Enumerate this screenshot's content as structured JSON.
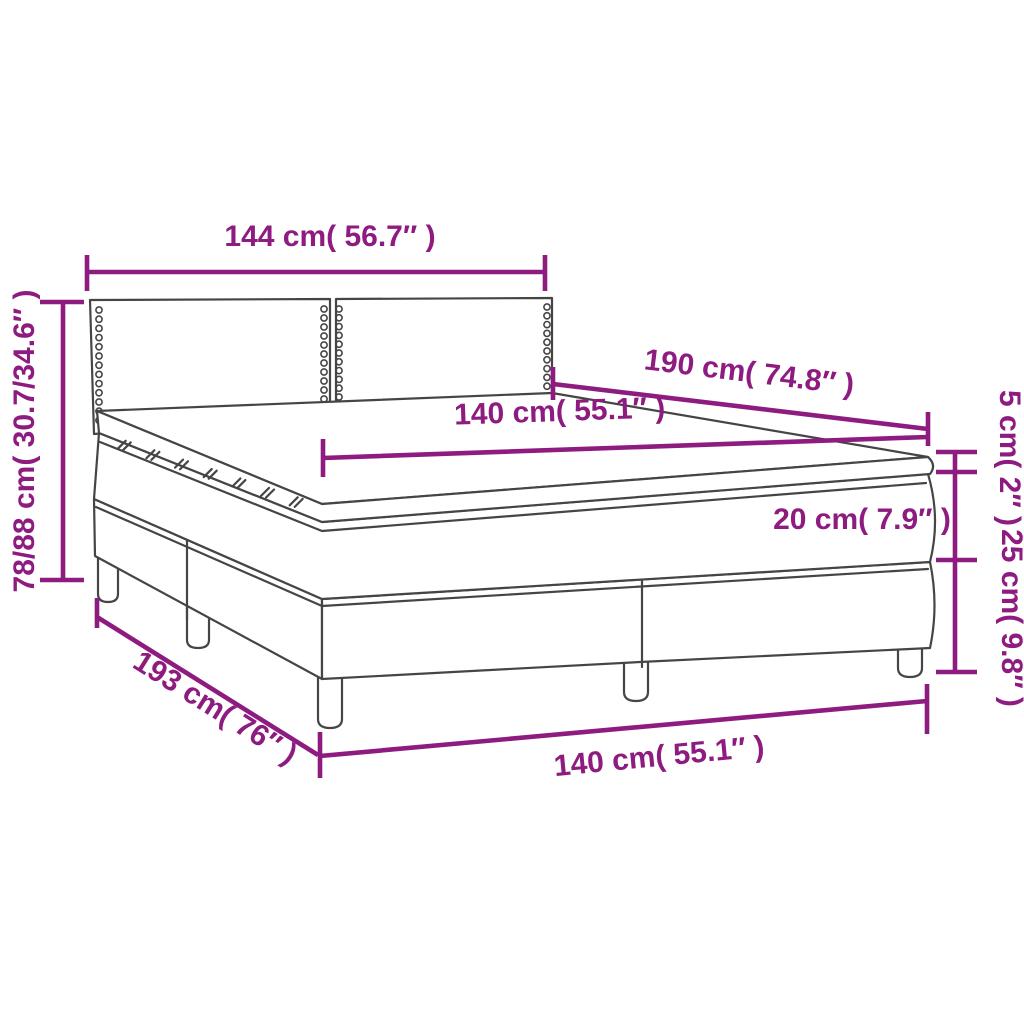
{
  "diagram": {
    "subject": "box-spring-bed-dimension-diagram",
    "colors": {
      "dimension_accent": "#8E1B7F",
      "line_art": "#454545",
      "background": "#FFFFFF"
    },
    "dimensions": {
      "headboard_width": "144 cm( 56.7″ )",
      "overall_height": "78/88 cm( 30.7/34.6″ )",
      "bed_length": "190 cm( 74.8″ )",
      "mattress_width": "140 cm( 55.1″ )",
      "topper_height": "5 cm( 2″ )",
      "mattress_height": "20 cm( 7.9″ )",
      "base_height": "25 cm( 9.8″ )",
      "base_length": "193 cm( 76″ )",
      "base_width": "140 cm( 55.1″ )"
    }
  }
}
